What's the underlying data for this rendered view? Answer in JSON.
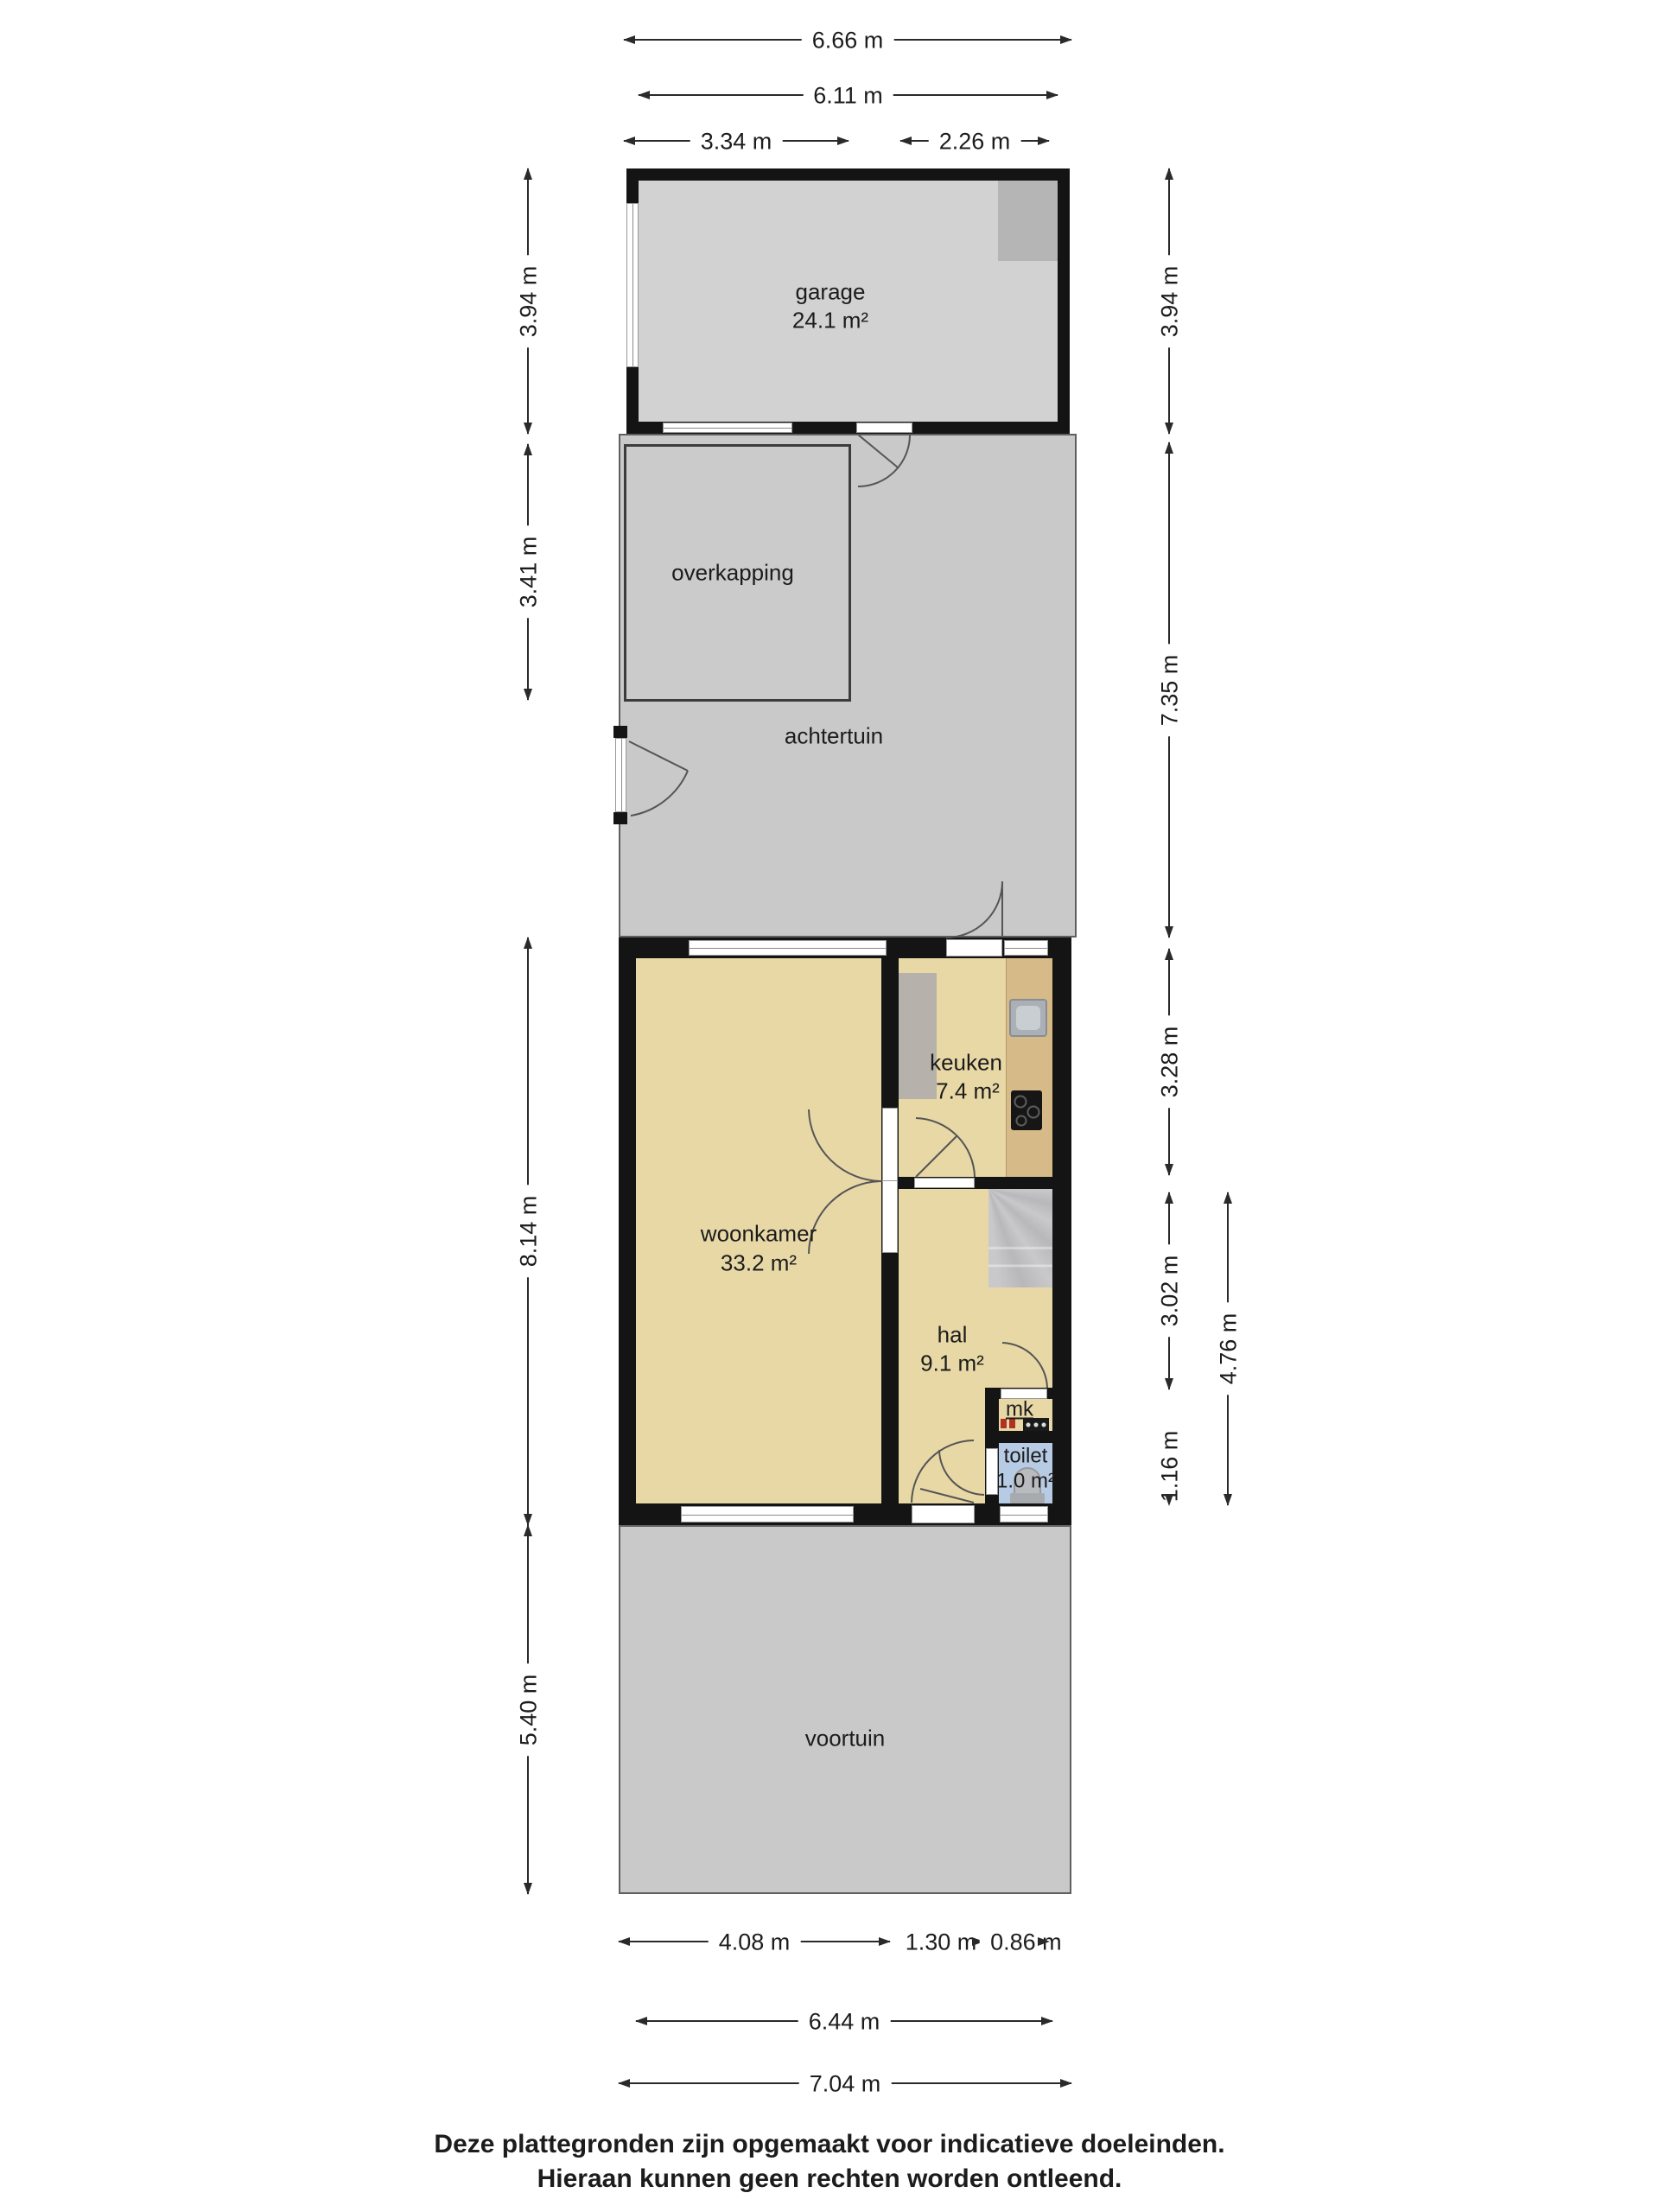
{
  "plan": {
    "rooms": {
      "garage": {
        "label": "garage",
        "area": "24.1 m²"
      },
      "overkapping": {
        "label": "overkapping"
      },
      "achtertuin": {
        "label": "achtertuin"
      },
      "woonkamer": {
        "label": "woonkamer",
        "area": "33.2 m²"
      },
      "keuken": {
        "label": "keuken",
        "area": "7.4 m²"
      },
      "hal": {
        "label": "hal",
        "area": "9.1 m²"
      },
      "mk": {
        "label": "mk"
      },
      "toilet": {
        "label": "toilet",
        "area": "1.0 m²"
      },
      "voortuin": {
        "label": "voortuin"
      }
    },
    "dimensions": {
      "top": {
        "total": "6.66 m",
        "inner": "6.11 m",
        "left_section": "3.34 m",
        "right_section": "2.26 m"
      },
      "left": {
        "garage": "3.94 m",
        "overkapping": "3.41 m",
        "house": "8.14 m",
        "voortuin": "5.40 m"
      },
      "right": {
        "garage": "3.94 m",
        "achtertuin": "7.35 m",
        "keuken": "3.28 m",
        "hal": "3.02 m",
        "toilet": "1.16 m",
        "hal_toilet": "4.76 m"
      },
      "bottom": {
        "woonkamer": "4.08 m",
        "hal": "1.30 m",
        "toilet": "0.86 m",
        "inner": "6.44 m",
        "total": "7.04 m"
      }
    },
    "colors": {
      "wall": "#141414",
      "garden": "#c9c9c9",
      "garage_floor": "#d2d2d2",
      "room_floor": "#e8d8a6",
      "kitchen_counter": "#d6ba88",
      "toilet_floor": "#b7cbe4",
      "stairs": "#c2c2c4",
      "dimension_line": "#2a2a2a"
    },
    "footer": {
      "line1": "Deze plattegronden zijn opgemaakt voor indicatieve doeleinden.",
      "line2": "Hieraan kunnen geen rechten worden ontleend."
    }
  }
}
